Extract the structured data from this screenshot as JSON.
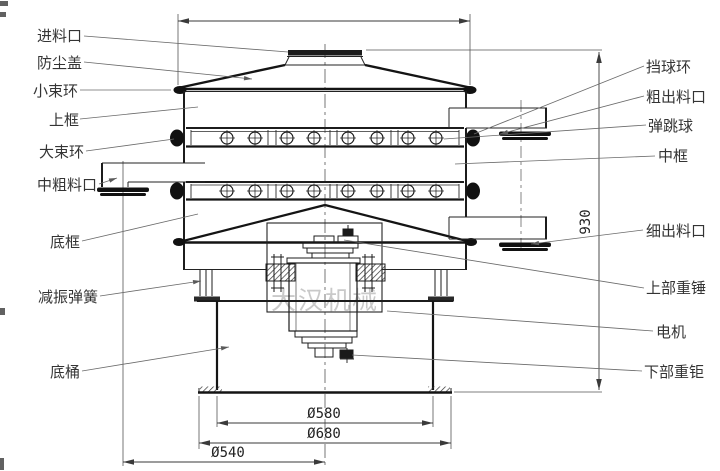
{
  "watermark": "大汉机械",
  "labels": {
    "left": [
      "进料口",
      "防尘盖",
      "小束环",
      "上框",
      "大束环",
      "中粗料口",
      "底框",
      "减振弹簧",
      "底桶"
    ],
    "right": [
      "挡球环",
      "粗出料口",
      "弹跳球",
      "中框",
      "细出料口",
      "上部重锤",
      "电机",
      "下部重钜"
    ]
  },
  "dimensions": {
    "overall_height": "930",
    "barrel_diameter": "Ø580",
    "base_flange_diameter": "Ø680",
    "outlet_flange_radius_line": "Ø540"
  },
  "colors": {
    "line": "#1c1c1c",
    "leader": "#6a6a6a",
    "watermark": "#c9c9c9",
    "background": "#ffffff"
  }
}
